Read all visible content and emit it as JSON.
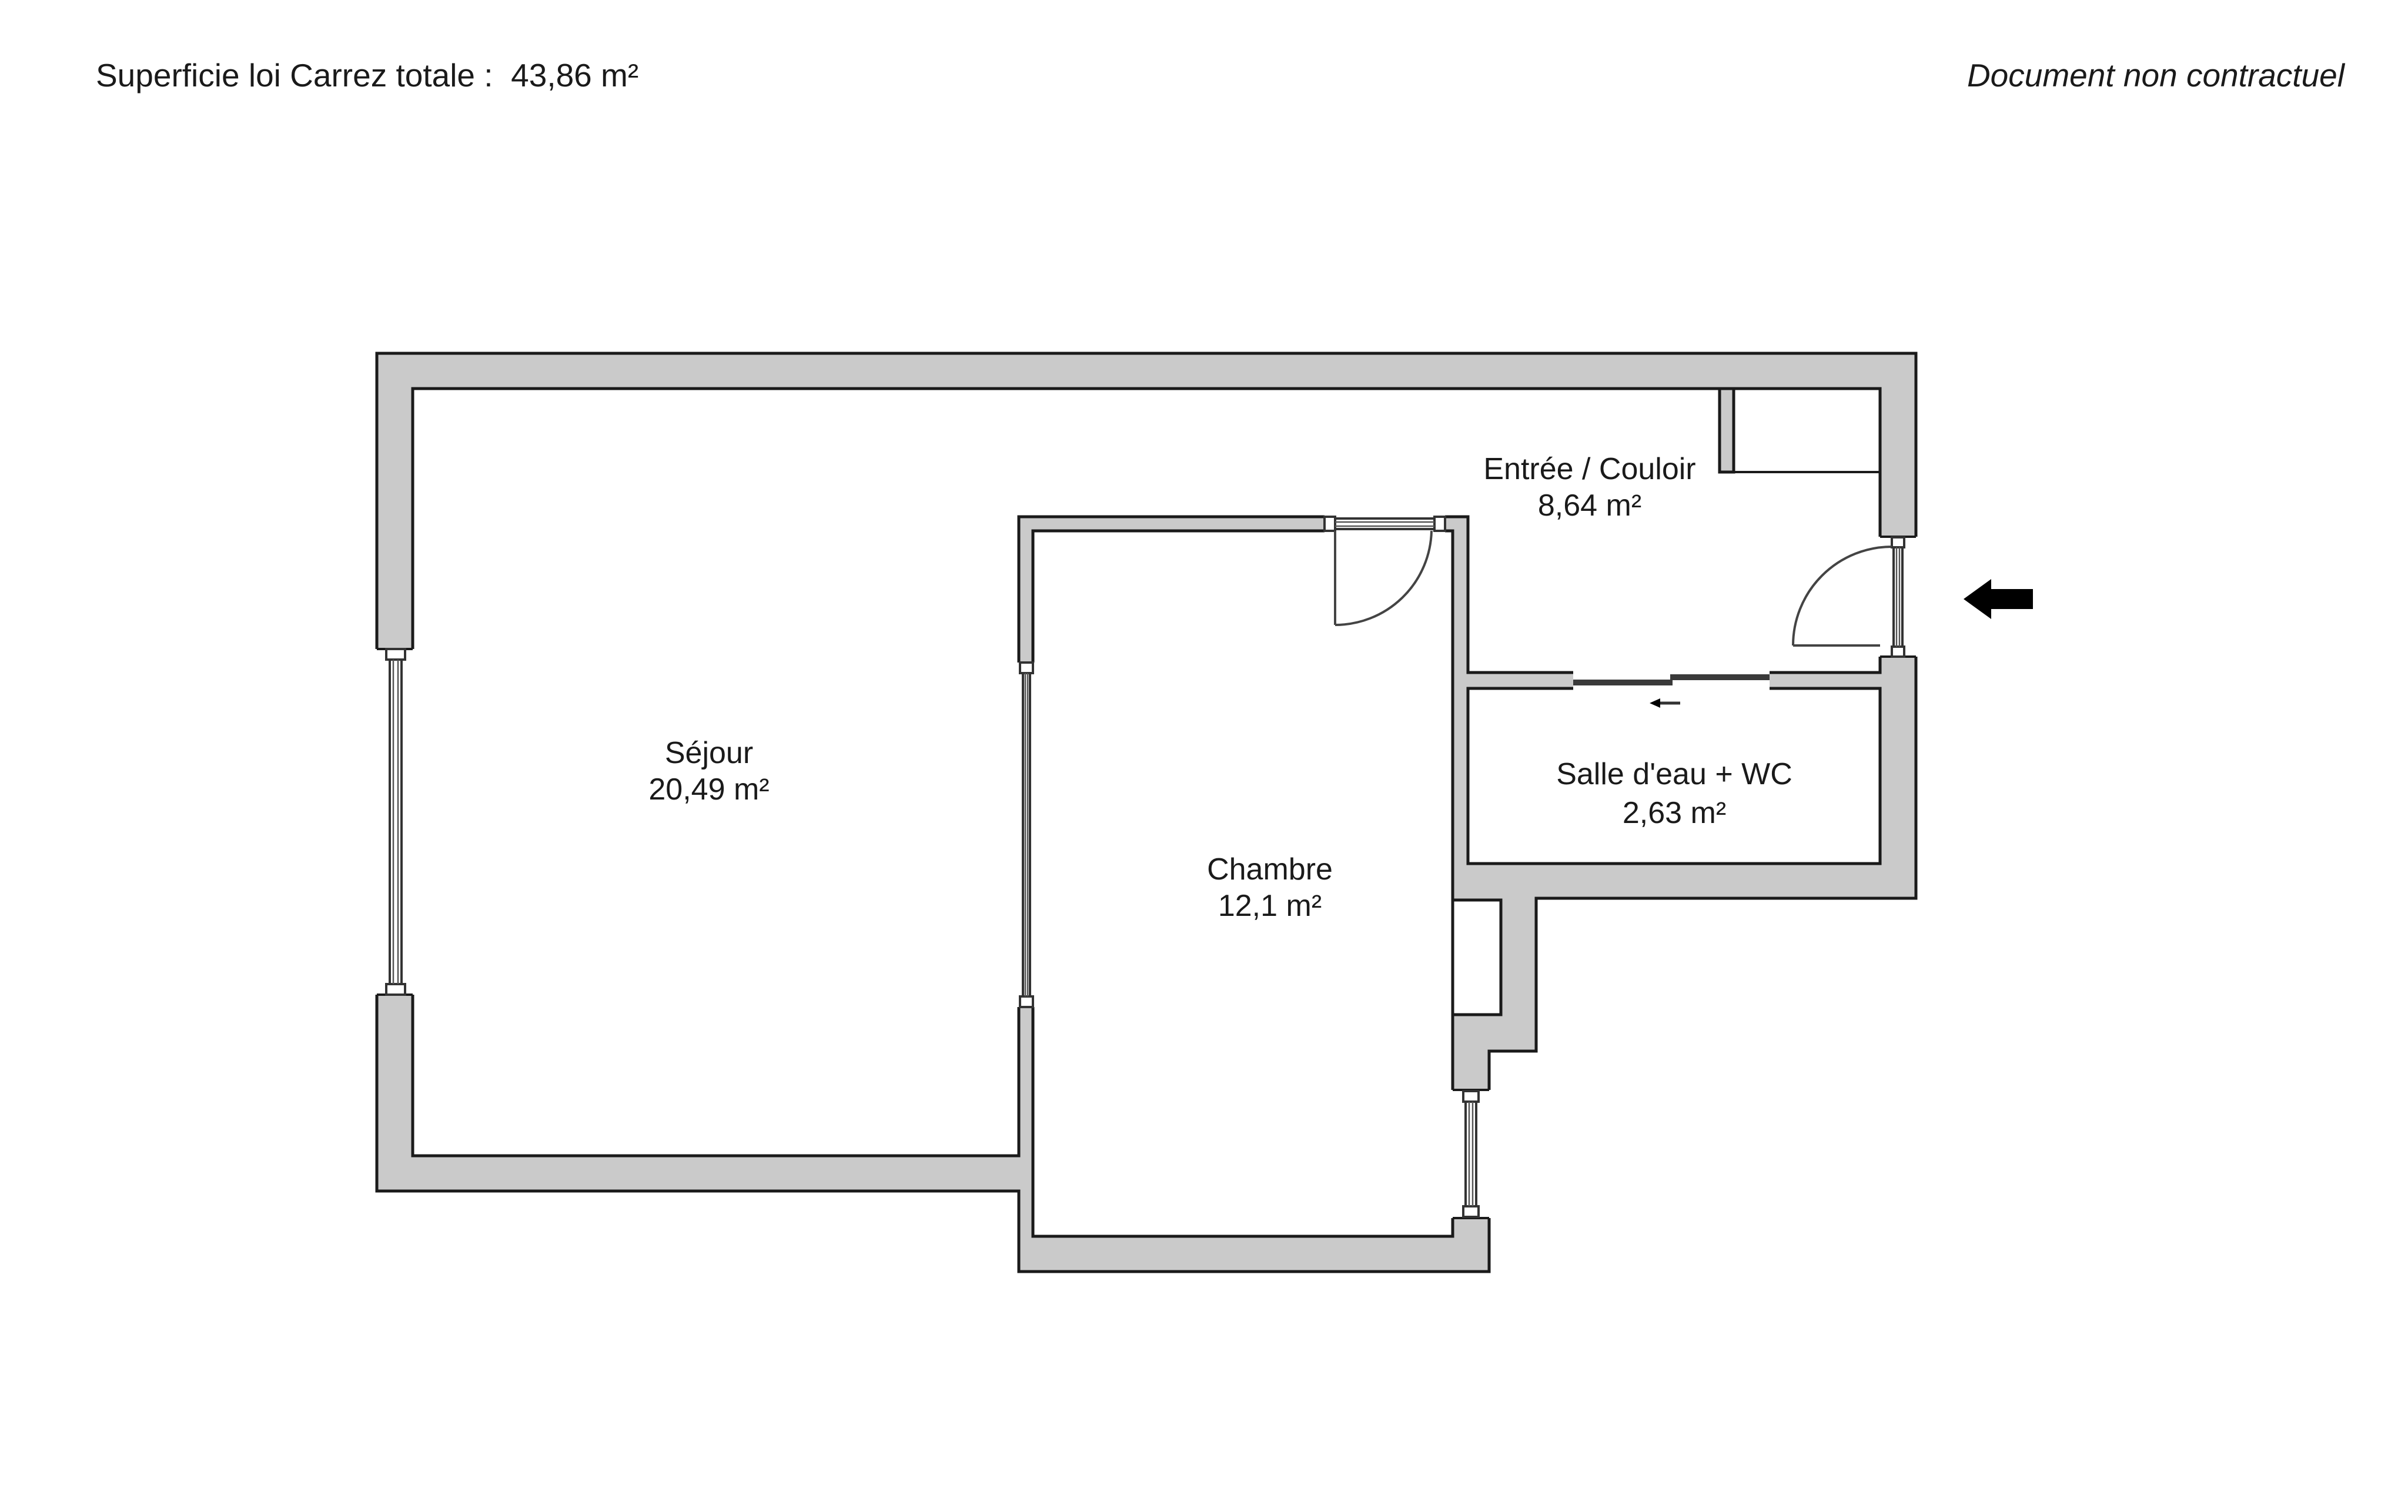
{
  "header": {
    "left": "Superficie loi Carrez totale :  43,86 m²",
    "right": "Document non contractuel"
  },
  "rooms": [
    {
      "name": "Entrée / Couloir",
      "area": "8,64 m²"
    },
    {
      "name": "Séjour",
      "area": "20,49 m²"
    },
    {
      "name": "Chambre",
      "area": "12,1 m²"
    },
    {
      "name": "Salle d'eau + WC",
      "area": "2,63 m²"
    }
  ],
  "icons": {
    "entrance_arrow": "left-arrow",
    "sliding_direction_arrow": "left-arrow"
  },
  "colors": {
    "background": "#ffffff",
    "wall_fill": "#cacaca",
    "outline": "#1a1a1a",
    "detail_line": "#3a3a3a",
    "entrance_arrow": "#000000",
    "text": "#1a1a1a"
  }
}
